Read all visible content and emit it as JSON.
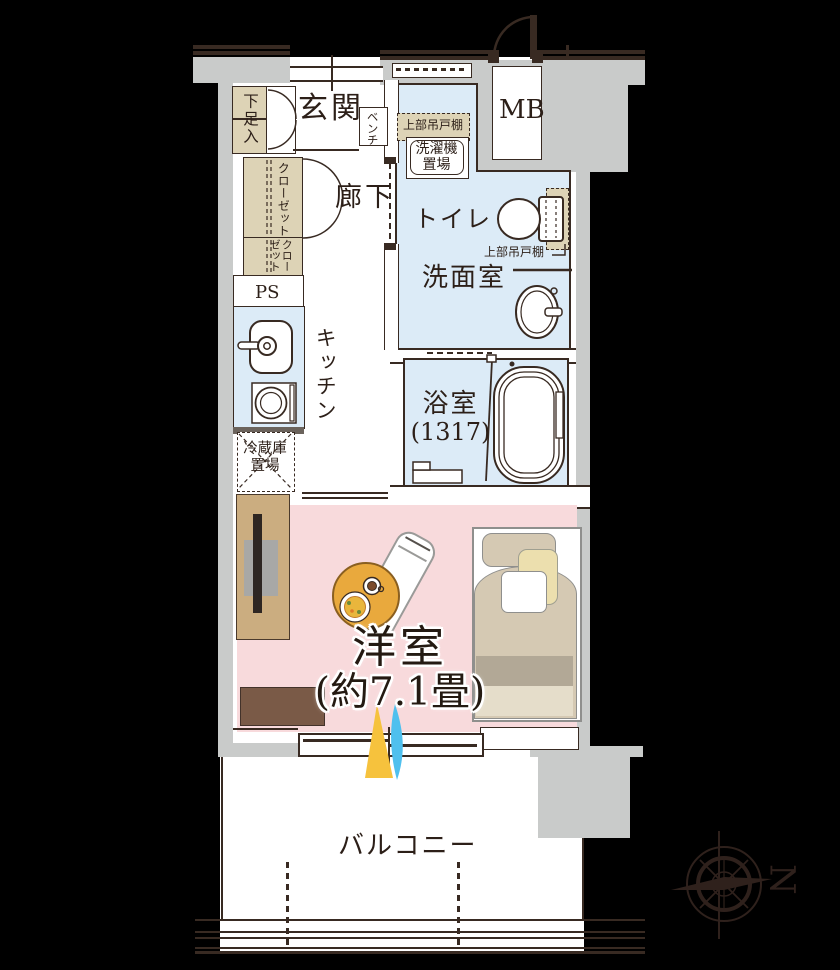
{
  "plan": {
    "rooms": {
      "genkan": "玄関",
      "shoe_cabinet": "下足入",
      "bench": "ベンチ",
      "meter_box": "MB",
      "corridor": "廊下",
      "closet": "クローゼット",
      "closet2_col1": "クロー",
      "closet2_col2": "ゼット",
      "pipe_space": "PS",
      "kitchen": "キッチン",
      "fridge_line1": "冷蔵庫",
      "fridge_line2": "置場",
      "laundry_upper_cabinet": "上部吊戸棚",
      "washer_line1": "洗濯機",
      "washer_line2": "置場",
      "toilet": "トイレ",
      "toilet_upper_cabinet": "上部吊戸棚",
      "washroom": "洗面室",
      "bath_name": "浴室",
      "bath_size": "(1317)",
      "western_name": "洋室",
      "western_size": "(約7.1畳)",
      "balcony": "バルコニー"
    },
    "compass": {
      "north": "N"
    },
    "colors": {
      "background": "#000000",
      "wall_fill": "#c9cbca",
      "ink": "#382a22",
      "water_rooms": "#dcebf7",
      "storage_tan": "#ddd3b6",
      "western_room_pink": "#f8dadc",
      "table_orange": "#e9a93d",
      "tv_board_wood": "#cbad80",
      "low_board_brown": "#7a5a47",
      "bed_tan": "#d5c9b3",
      "sunlight_yellow": "#f6c23d",
      "breeze_blue": "#4fc0ee"
    }
  }
}
